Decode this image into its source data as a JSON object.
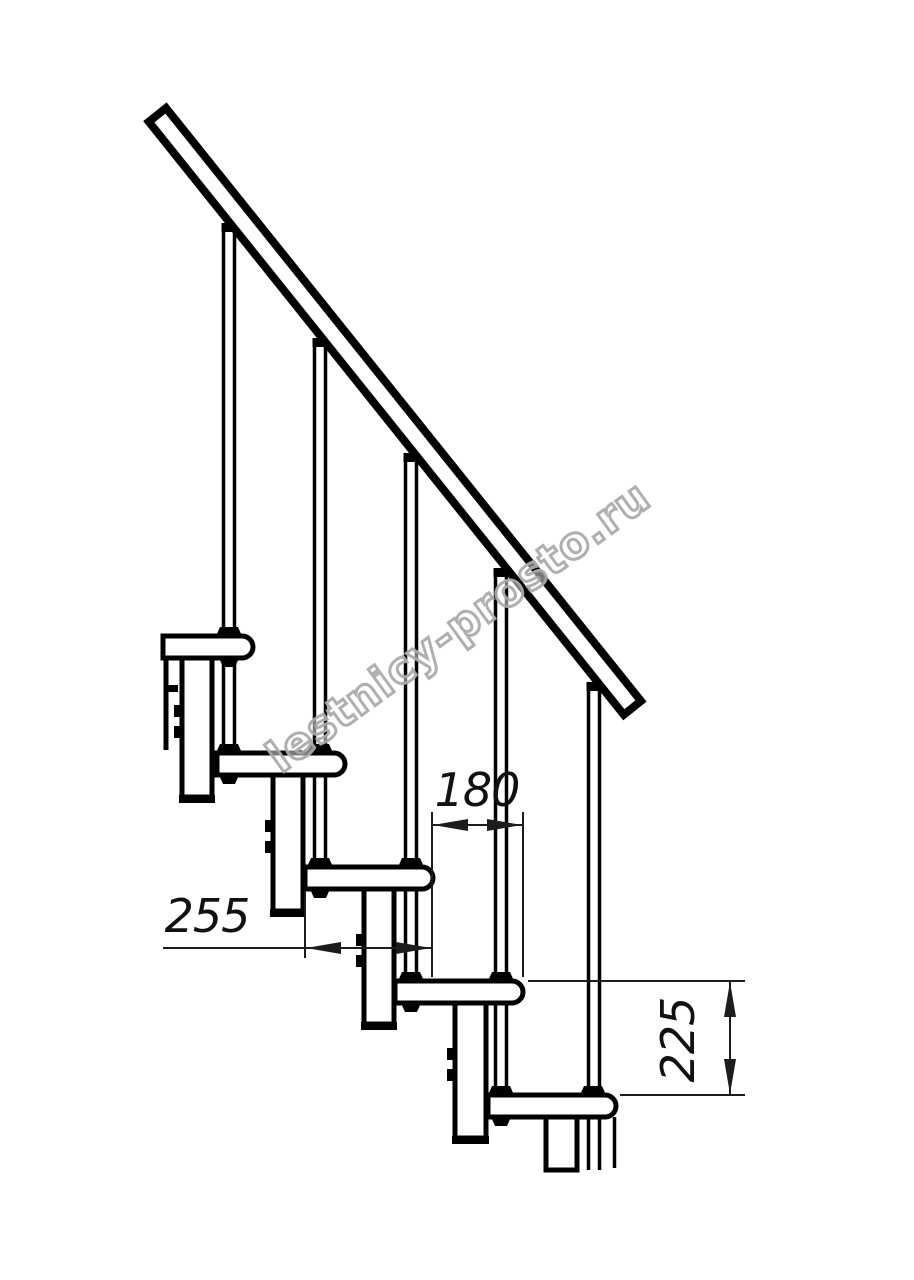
{
  "drawing": {
    "watermark": "lestnicy-prosto.ru",
    "dimensions": {
      "step_run": "180",
      "tread_depth": "255",
      "step_rise": "225"
    }
  }
}
